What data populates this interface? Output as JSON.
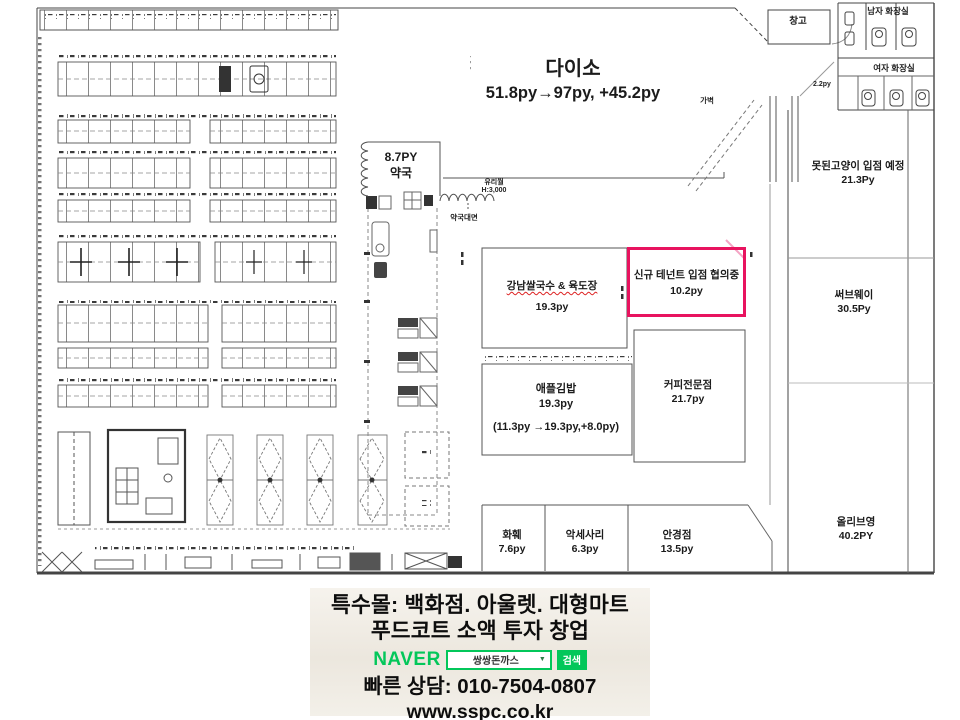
{
  "plan": {
    "daiso": {
      "name": "다이소",
      "size": "51.8py→97py, +45.2py"
    },
    "pharmacy": {
      "size": "8.7PY",
      "name": "약국"
    },
    "glass_wall": {
      "line1": "유리월",
      "line2": "H:3,000"
    },
    "pharmacy_front": "약국대면",
    "partition": "가벽",
    "gangnam": {
      "name": "강남쌀국수 & 육도장",
      "size": "19.3py"
    },
    "new_tenant": {
      "name": "신규 테넌트 입점 협의중",
      "size": "10.2py",
      "highlight_color": "#e8135f"
    },
    "apple_gimbap": {
      "name": "애플김밥",
      "size": "19.3py",
      "note": "(11.3py →19.3py,+8.0py)"
    },
    "coffee": {
      "name": "커피전문점",
      "size": "21.7py"
    },
    "flower": {
      "name": "화훼",
      "size": "7.6py"
    },
    "accessory": {
      "name": "악세사리",
      "size": "6.3py"
    },
    "optician": {
      "name": "안경점",
      "size": "13.5py"
    },
    "bad_cat": {
      "name": "못된고양이 입점 예정",
      "size": "21.3Py"
    },
    "subway": {
      "name": "써브웨이",
      "size": "30.5Py"
    },
    "olive_young": {
      "name": "올리브영",
      "size": "40.2PY"
    },
    "storage": "창고",
    "mens_restroom": "남자 화장실",
    "womens_restroom": "여자 화장실",
    "small_room_size": "2.2py"
  },
  "banner": {
    "line1": "특수몰: 백화점. 아울렛. 대형마트",
    "line2": "푸드코트 소액 투자 창업",
    "naver_logo": "NAVER",
    "search_value": "쌍쌍돈까스",
    "search_button": "검색",
    "contact": "빠른 상담: 010-7504-0807",
    "website": "www.sspc.co.kr",
    "naver_green": "#03c75a"
  }
}
